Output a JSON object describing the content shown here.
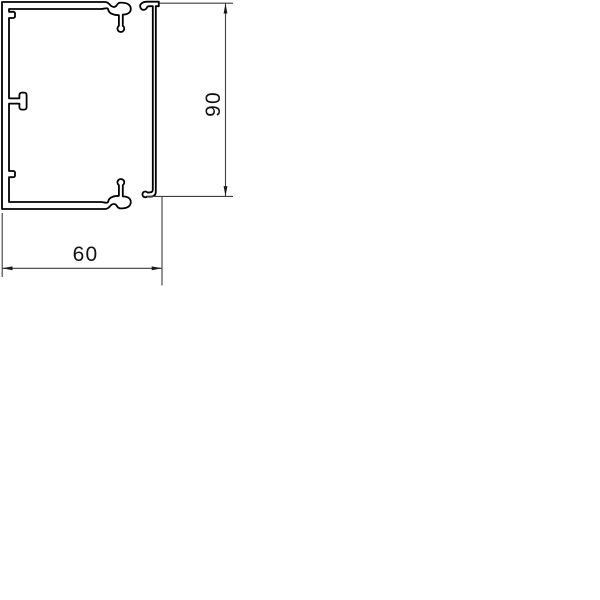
{
  "drawing": {
    "kind": "technical-cross-section",
    "dimensions": {
      "width": {
        "value": "60"
      },
      "height": {
        "value": "90"
      }
    },
    "colors": {
      "profile_outline": "#000000",
      "dimension_line": "#3d3d3d",
      "arrow_fill": "#1a1a1a",
      "background": "#ffffff"
    }
  }
}
